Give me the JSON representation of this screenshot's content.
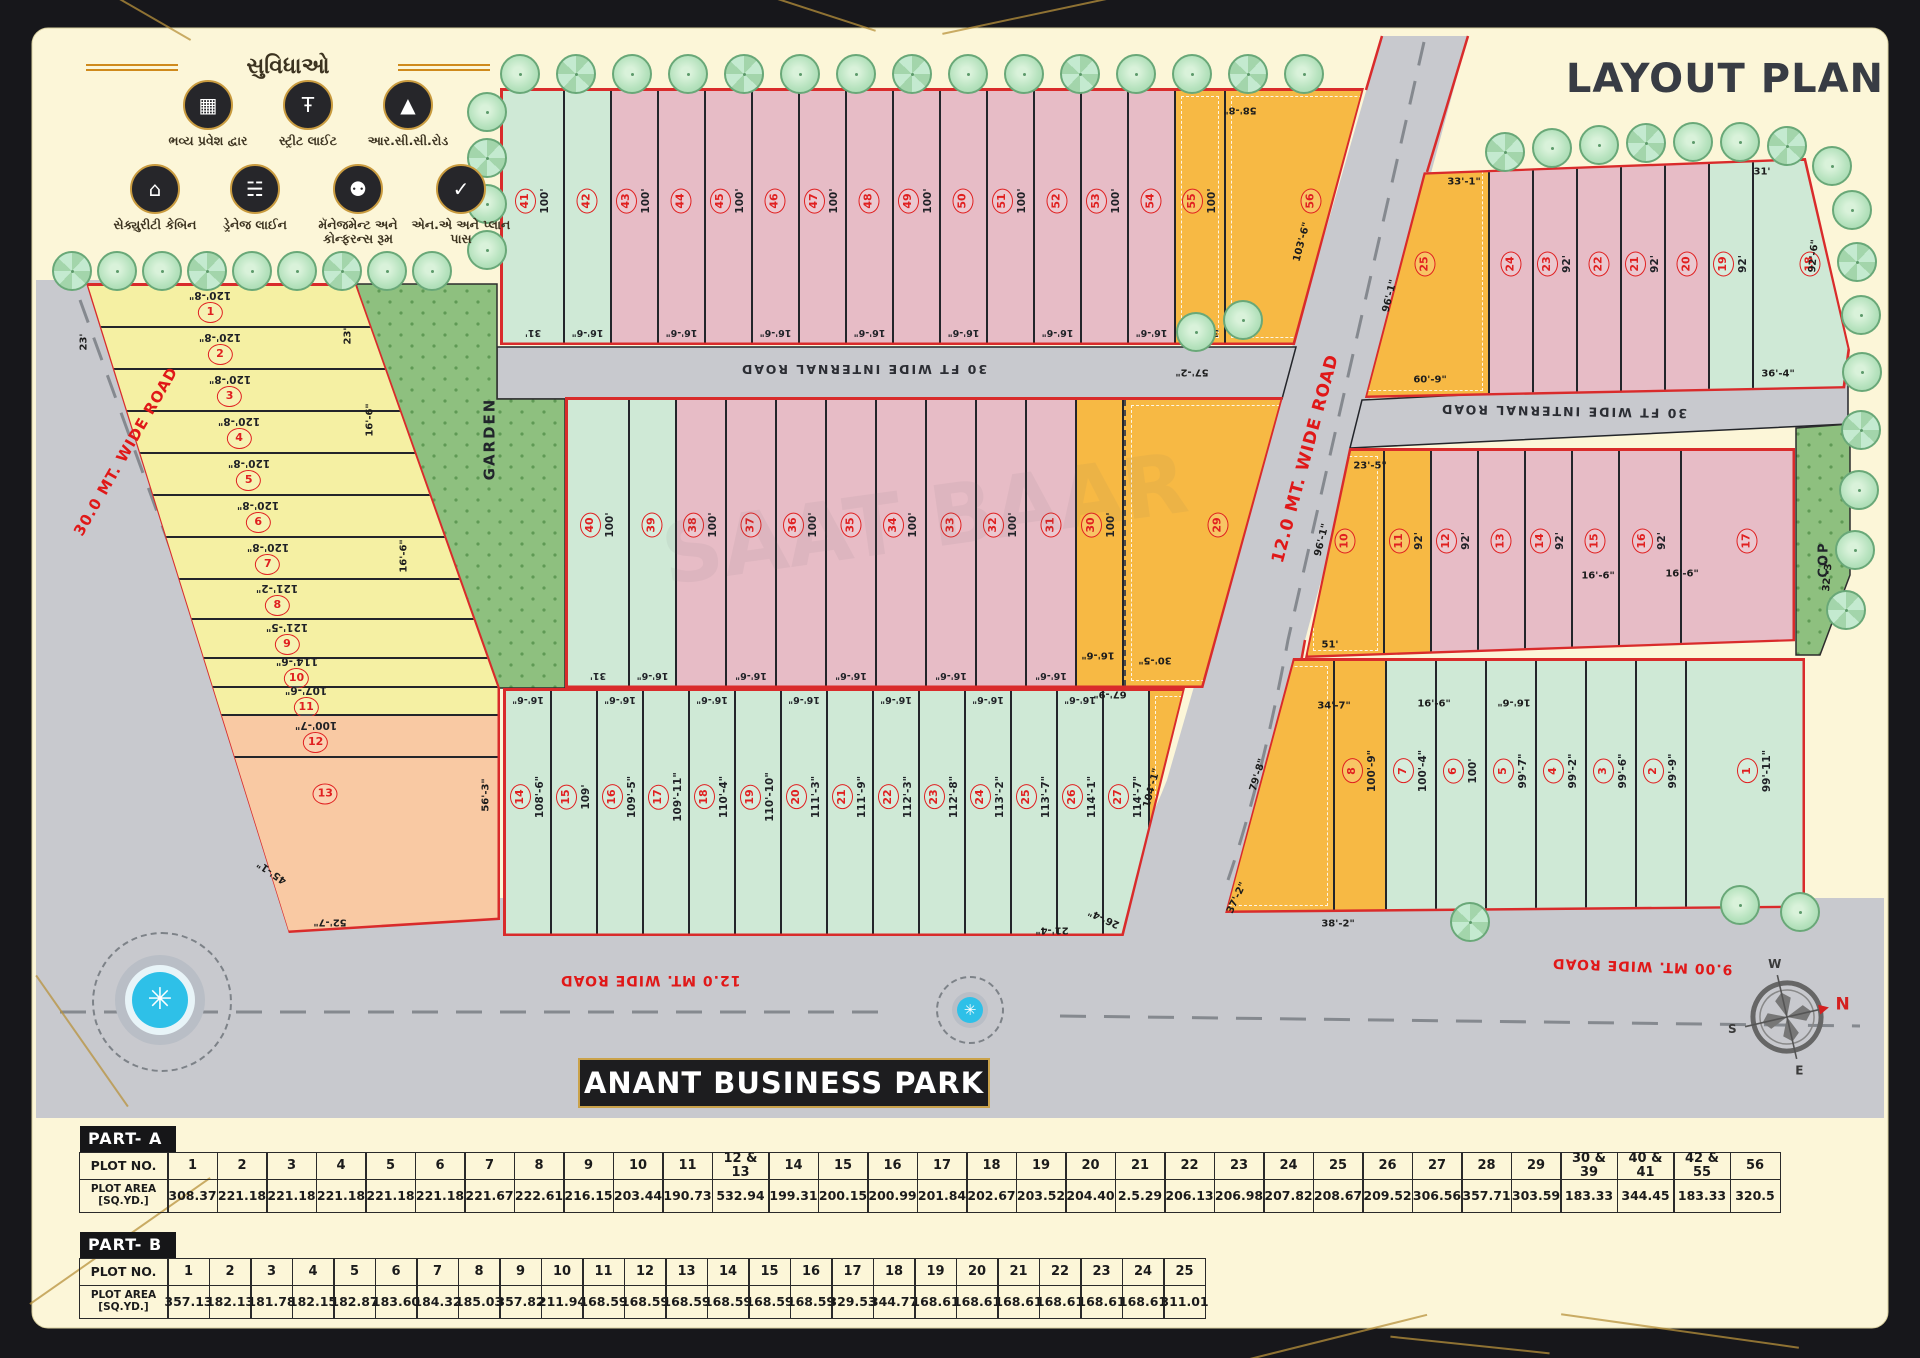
{
  "title": "LAYOUT PLAN",
  "project_name": "ANANT BUSINESS PARK",
  "watermark": "SAAT BAAR",
  "palette": {
    "green": "#cfe9d6",
    "pink": "#e7bcc6",
    "orange": "#f7b944",
    "yellow": "#f5f0a3",
    "salmon": "#f9c9a3",
    "road": "#c8c9ce",
    "boundary": "#d92b2b",
    "garden": "#8ec07f",
    "cream": "#fcf6d8",
    "frame_gold": "#b8913c",
    "plot_number_red": "#e02020"
  },
  "legend": {
    "heading": "સુવિધાઓ",
    "items": [
      {
        "icon": "entrance-gate-icon",
        "glyph": "▦",
        "label": "ભવ્ય પ્રવેશ દ્વાર"
      },
      {
        "icon": "street-light-icon",
        "glyph": "Ŧ",
        "label": "સ્ટ્રીટ લાઈટ"
      },
      {
        "icon": "rcc-road-icon",
        "glyph": "▲",
        "label": "આર.સી.સી.રોડ"
      },
      {
        "icon": "security-cabin-icon",
        "glyph": "⌂",
        "label": "સેક્યુરીટી કેબિન"
      },
      {
        "icon": "drainage-line-icon",
        "glyph": "☵",
        "label": "ડ્રેનેજ લાઈન"
      },
      {
        "icon": "conference-room-icon",
        "glyph": "⚉",
        "label": "મૅનેજમેન્ટ અને કોન્ફરન્સ રૂમ"
      },
      {
        "icon": "plan-pass-icon",
        "glyph": "✓",
        "label": "એન.એ અને પ્લાન પાસ"
      }
    ]
  },
  "roads": {
    "left": "30.0 MT. WIDE ROAD",
    "main": "12.0 MT. WIDE ROAD",
    "bottom_left": "12.0 MT. WIDE ROAD",
    "bottom_right": "9.00 MT. WIDE ROAD",
    "internal_top": "30 FT  WIDE INTERNAL ROAD",
    "internal_right": "30 FT  WIDE INTERNAL ROAD"
  },
  "areas": {
    "garden": "GARDEN",
    "cop": "COP"
  },
  "compass": {
    "n": "N",
    "e": "E",
    "s": "S",
    "w": "W"
  },
  "blocks": {
    "top": {
      "plots": [
        {
          "no": "41",
          "c": "green",
          "len": "100'",
          "wid": "31'"
        },
        {
          "no": "42",
          "c": "green",
          "wid": "16'-6\""
        },
        {
          "no": "43",
          "c": "pink",
          "len": "100'"
        },
        {
          "no": "44",
          "c": "pink",
          "wid": "16'-6\""
        },
        {
          "no": "45",
          "c": "pink",
          "len": "100'"
        },
        {
          "no": "46",
          "c": "pink",
          "wid": "16'-6\""
        },
        {
          "no": "47",
          "c": "pink",
          "len": "100'"
        },
        {
          "no": "48",
          "c": "pink",
          "wid": "16'-6\""
        },
        {
          "no": "49",
          "c": "pink",
          "len": "100'"
        },
        {
          "no": "50",
          "c": "pink",
          "wid": "16'-6\""
        },
        {
          "no": "51",
          "c": "pink",
          "len": "100'"
        },
        {
          "no": "52",
          "c": "pink",
          "wid": "16'-6\""
        },
        {
          "no": "53",
          "c": "pink",
          "len": "100'"
        },
        {
          "no": "54",
          "c": "pink",
          "wid": "16'-6\""
        },
        {
          "no": "55",
          "c": "orange",
          "len": "100'",
          "wid": "31'-11\"",
          "sb": true
        },
        {
          "no": "56",
          "c": "orange",
          "sb": true
        }
      ]
    },
    "mid": {
      "plots": [
        {
          "no": "40",
          "c": "green",
          "len": "100'",
          "wid": "31'"
        },
        {
          "no": "39",
          "c": "green",
          "wid": "16'-6\""
        },
        {
          "no": "38",
          "c": "pink",
          "len": "100'"
        },
        {
          "no": "37",
          "c": "pink",
          "wid": "16'-6\""
        },
        {
          "no": "36",
          "c": "pink",
          "len": "100'"
        },
        {
          "no": "35",
          "c": "pink",
          "wid": "16'-6\""
        },
        {
          "no": "34",
          "c": "pink",
          "len": "100'"
        },
        {
          "no": "33",
          "c": "pink",
          "wid": "16'-6\""
        },
        {
          "no": "32",
          "c": "pink",
          "len": "100'"
        },
        {
          "no": "31",
          "c": "pink",
          "wid": "16'-6\""
        },
        {
          "no": "30",
          "c": "orange",
          "len": "100'"
        },
        {
          "no": "29",
          "c": "orange",
          "dashL": true,
          "sb": true
        }
      ]
    },
    "bmid": {
      "plots": [
        {
          "no": "14",
          "c": "green",
          "len": "108'-6\"",
          "twid": "16'-6\""
        },
        {
          "no": "15",
          "c": "green",
          "len": "109'"
        },
        {
          "no": "16",
          "c": "green",
          "len": "109'-5\"",
          "twid": "16'-6\""
        },
        {
          "no": "17",
          "c": "green",
          "len": "109'-11\""
        },
        {
          "no": "18",
          "c": "green",
          "len": "110'-4\"",
          "twid": "16'-6\""
        },
        {
          "no": "19",
          "c": "green",
          "len": "110'-10\""
        },
        {
          "no": "20",
          "c": "green",
          "len": "111'-3\"",
          "twid": "16'-6\""
        },
        {
          "no": "21",
          "c": "green",
          "len": "111'-9\""
        },
        {
          "no": "22",
          "c": "green",
          "len": "112'-3\"",
          "twid": "16'-6\""
        },
        {
          "no": "23",
          "c": "green",
          "len": "112'-8\""
        },
        {
          "no": "24",
          "c": "green",
          "len": "113'-2\"",
          "twid": "16'-6\""
        },
        {
          "no": "25",
          "c": "green",
          "len": "113'-7\""
        },
        {
          "no": "26",
          "c": "green",
          "len": "114'-1\"",
          "twid": "16'-6\""
        },
        {
          "no": "27",
          "c": "green",
          "len": "114'-7\""
        },
        {
          "no": "28",
          "c": "orange",
          "sb": true
        }
      ]
    },
    "left": {
      "plots": [
        {
          "no": "1",
          "c": "yellow",
          "len": "120'-8\""
        },
        {
          "no": "2",
          "c": "yellow",
          "len": "120'-8\""
        },
        {
          "no": "3",
          "c": "yellow",
          "len": "120'-8\""
        },
        {
          "no": "4",
          "c": "yellow",
          "len": "120'-8\""
        },
        {
          "no": "5",
          "c": "yellow",
          "len": "120'-8\""
        },
        {
          "no": "6",
          "c": "yellow",
          "len": "120'-8\""
        },
        {
          "no": "7",
          "c": "yellow",
          "len": "120'-8\""
        },
        {
          "no": "8",
          "c": "yellow",
          "len": "121'-2\""
        },
        {
          "no": "9",
          "c": "yellow",
          "len": "121'-5\""
        },
        {
          "no": "10",
          "c": "yellow",
          "len": "114'-6\""
        },
        {
          "no": "11",
          "c": "yellow",
          "len": "107'-6\""
        },
        {
          "no": "12",
          "c": "salmon",
          "len": "100'-7\""
        },
        {
          "no": "13",
          "c": "salmon",
          "ly": 18
        }
      ]
    },
    "r1": {
      "plots": [
        {
          "no": "25",
          "c": "orange",
          "sb": true
        },
        {
          "no": "24",
          "c": "pink"
        },
        {
          "no": "23",
          "c": "pink",
          "len": "92'"
        },
        {
          "no": "22",
          "c": "pink"
        },
        {
          "no": "21",
          "c": "pink",
          "len": "92'"
        },
        {
          "no": "20",
          "c": "pink"
        },
        {
          "no": "19",
          "c": "green",
          "len": "92'"
        },
        {
          "no": "18",
          "c": "green"
        }
      ]
    },
    "r2": {
      "plots": [
        {
          "no": "10",
          "c": "orange",
          "sb": true
        },
        {
          "no": "11",
          "c": "orange",
          "len": "92'"
        },
        {
          "no": "12",
          "c": "pink",
          "len": "92'"
        },
        {
          "no": "13",
          "c": "pink"
        },
        {
          "no": "14",
          "c": "pink",
          "len": "92'"
        },
        {
          "no": "15",
          "c": "pink"
        },
        {
          "no": "16",
          "c": "pink",
          "len": "92'"
        },
        {
          "no": "17",
          "c": "pink"
        }
      ]
    },
    "r3": {
      "plots": [
        {
          "no": "9",
          "c": "orange",
          "sb": true
        },
        {
          "no": "8",
          "c": "orange",
          "len": "100'-9\""
        },
        {
          "no": "7",
          "c": "green",
          "len": "100'-4\""
        },
        {
          "no": "6",
          "c": "green",
          "len": "100'"
        },
        {
          "no": "5",
          "c": "green",
          "len": "99'-7\""
        },
        {
          "no": "4",
          "c": "green",
          "len": "99'-2\""
        },
        {
          "no": "3",
          "c": "green",
          "len": "99'-6\""
        },
        {
          "no": "2",
          "c": "green",
          "len": "99'-9\""
        },
        {
          "no": "1",
          "c": "green",
          "len": "99'-11\""
        }
      ]
    }
  },
  "stray_labels": [
    {
      "t": "58'-8\"",
      "x": 1240,
      "y": 110,
      "r": 180
    },
    {
      "t": "103'-6\"",
      "x": 1302,
      "y": 242,
      "r": -75
    },
    {
      "t": "57'-2\"",
      "x": 1192,
      "y": 372,
      "r": 180
    },
    {
      "t": "30'-5\"",
      "x": 1155,
      "y": 660,
      "r": 180
    },
    {
      "t": "67'-9\"",
      "x": 1110,
      "y": 694,
      "r": 180
    },
    {
      "t": "16'-6\"",
      "x": 1098,
      "y": 655,
      "r": 180
    },
    {
      "t": "104'-1\"",
      "x": 1152,
      "y": 788,
      "r": -75
    },
    {
      "t": "26'-4\"",
      "x": 1104,
      "y": 918,
      "r": 205
    },
    {
      "t": "21'-4\"",
      "x": 1052,
      "y": 930,
      "r": 180
    },
    {
      "t": "37'-2\"",
      "x": 1237,
      "y": 898,
      "r": -65
    },
    {
      "t": "38'-2\"",
      "x": 1338,
      "y": 924,
      "r": 0
    },
    {
      "t": "79'-8\"",
      "x": 1258,
      "y": 775,
      "r": -73
    },
    {
      "t": "34'-7\"",
      "x": 1334,
      "y": 706,
      "r": 0
    },
    {
      "t": "16'-6\"",
      "x": 1434,
      "y": 704,
      "r": 0
    },
    {
      "t": "16'-6\"",
      "x": 1514,
      "y": 702,
      "r": 180
    },
    {
      "t": "51'",
      "x": 1330,
      "y": 645,
      "r": 0
    },
    {
      "t": "96'-1\"",
      "x": 1322,
      "y": 540,
      "r": -76
    },
    {
      "t": "23'-5\"",
      "x": 1370,
      "y": 466,
      "r": 0
    },
    {
      "t": "16'-6\"",
      "x": 1598,
      "y": 576,
      "r": 0
    },
    {
      "t": "16'-6\"",
      "x": 1682,
      "y": 574,
      "r": 0
    },
    {
      "t": "32'-3\"",
      "x": 1828,
      "y": 575,
      "r": -85
    },
    {
      "t": "96'-1\"",
      "x": 1390,
      "y": 296,
      "r": -76
    },
    {
      "t": "60'-9\"",
      "x": 1430,
      "y": 380,
      "r": 0
    },
    {
      "t": "33'-1\"",
      "x": 1464,
      "y": 182,
      "r": 0
    },
    {
      "t": "31'",
      "x": 1762,
      "y": 172,
      "r": 0
    },
    {
      "t": "92'-6\"",
      "x": 1814,
      "y": 256,
      "r": -85
    },
    {
      "t": "36'-4\"",
      "x": 1778,
      "y": 374,
      "r": 0
    },
    {
      "t": "23'",
      "x": 84,
      "y": 342,
      "r": -90
    },
    {
      "t": "23'",
      "x": 348,
      "y": 336,
      "r": -90
    },
    {
      "t": "16'-6\"",
      "x": 370,
      "y": 420,
      "r": -90
    },
    {
      "t": "16'-6\"",
      "x": 404,
      "y": 556,
      "r": -90
    },
    {
      "t": "56'-3\"",
      "x": 486,
      "y": 795,
      "r": -90
    },
    {
      "t": "52'-7\"",
      "x": 330,
      "y": 922,
      "r": 180
    },
    {
      "t": "45'-1\"",
      "x": 272,
      "y": 872,
      "r": 215
    }
  ],
  "tables": [
    {
      "name": "PART- A",
      "plot_no_label": "PLOT NO.",
      "area_label_lines": [
        "PLOT AREA",
        "[SQ.YD.]"
      ],
      "cols": [
        "1",
        "2",
        "3",
        "4",
        "5",
        "6",
        "7",
        "8",
        "9",
        "10",
        "11",
        "12 & 13",
        "14",
        "15",
        "16",
        "17",
        "18",
        "19",
        "20",
        "21",
        "22",
        "23",
        "24",
        "25",
        "26",
        "27",
        "28",
        "29",
        "30 & 39",
        "40 & 41",
        "42 & 55",
        "56"
      ],
      "areas": [
        "308.37",
        "221.18",
        "221.18",
        "221.18",
        "221.18",
        "221.18",
        "221.67",
        "222.61",
        "216.15",
        "203.44",
        "190.73",
        "532.94",
        "199.31",
        "200.15",
        "200.99",
        "201.84",
        "202.67",
        "203.52",
        "204.40",
        "2.5.29",
        "206.13",
        "206.98",
        "207.82",
        "208.67",
        "209.52",
        "306.56",
        "357.71",
        "303.59",
        "183.33",
        "344.45",
        "183.33",
        "320.5"
      ]
    },
    {
      "name": "PART- B",
      "plot_no_label": "PLOT NO.",
      "area_label_lines": [
        "PLOT AREA",
        "[SQ.YD.]"
      ],
      "cols": [
        "1",
        "2",
        "3",
        "4",
        "5",
        "6",
        "7",
        "8",
        "9",
        "10",
        "11",
        "12",
        "13",
        "14",
        "15",
        "16",
        "17",
        "18",
        "19",
        "20",
        "21",
        "22",
        "23",
        "24",
        "25"
      ],
      "areas": [
        "357.13",
        "182.13",
        "181.78",
        "182.15",
        "182.87",
        "183.60",
        "184.32",
        "185.03",
        "357.82",
        "211.94",
        "168.59",
        "168.59",
        "168.59",
        "168.59",
        "168.59",
        "168.59",
        "329.53",
        "344.77",
        "168.61",
        "168.61",
        "168.61",
        "168.61",
        "168.61",
        "168.61",
        "311.01"
      ]
    }
  ]
}
